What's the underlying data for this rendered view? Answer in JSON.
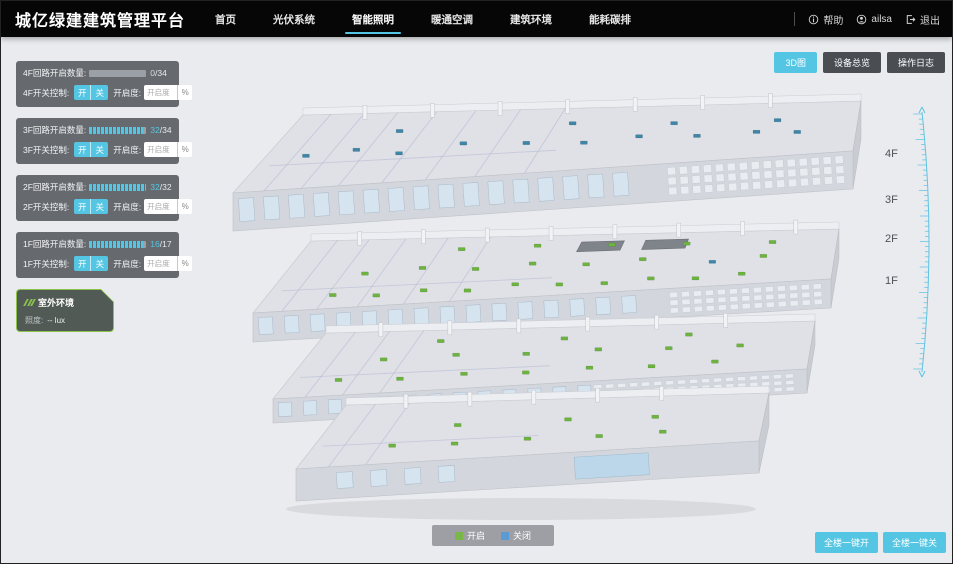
{
  "header": {
    "title": "城亿绿建建筑管理平台",
    "nav": [
      {
        "label": "首页",
        "active": false
      },
      {
        "label": "光伏系统",
        "active": false
      },
      {
        "label": "智能照明",
        "active": true
      },
      {
        "label": "暖通空调",
        "active": false
      },
      {
        "label": "建筑环境",
        "active": false
      },
      {
        "label": "能耗碳排",
        "active": false
      }
    ],
    "help_label": "帮助",
    "user_name": "ailsa",
    "logout_label": "退出"
  },
  "view_toolbar": {
    "buttons": [
      {
        "label": "3D图",
        "active": true
      },
      {
        "label": "设备总览",
        "active": false
      },
      {
        "label": "操作日志",
        "active": false
      }
    ]
  },
  "floor_panels": [
    {
      "floor": "4F",
      "circuit_label": "4F回路开启数量:",
      "current": "0",
      "total": "34",
      "progress": 0,
      "switch_label": "4F开关控制:",
      "on_label": "开",
      "off_label": "关",
      "dim_label": "开启度:",
      "dim_placeholder": "开启度",
      "unit_label": "%"
    },
    {
      "floor": "3F",
      "circuit_label": "3F回路开启数量:",
      "current": "32",
      "total": "34",
      "progress": 94,
      "switch_label": "3F开关控制:",
      "on_label": "开",
      "off_label": "关",
      "dim_label": "开启度:",
      "dim_placeholder": "开启度",
      "unit_label": "%"
    },
    {
      "floor": "2F",
      "circuit_label": "2F回路开启数量:",
      "current": "32",
      "total": "32",
      "progress": 100,
      "switch_label": "2F开关控制:",
      "on_label": "开",
      "off_label": "关",
      "dim_label": "开启度:",
      "dim_placeholder": "开启度",
      "unit_label": "%"
    },
    {
      "floor": "1F",
      "circuit_label": "1F回路开启数量:",
      "current": "16",
      "total": "17",
      "progress": 94,
      "switch_label": "1F开关控制:",
      "on_label": "开",
      "off_label": "关",
      "dim_label": "开启度:",
      "dim_placeholder": "开启度",
      "unit_label": "%"
    }
  ],
  "outdoor_panel": {
    "title": "室外环境",
    "metric_label": "照度:",
    "metric_value": "--",
    "metric_unit": "lux"
  },
  "floor_scale": {
    "labels": [
      "4F",
      "3F",
      "2F",
      "1F"
    ]
  },
  "legend": {
    "items": [
      {
        "label": "开启",
        "color": "#7ab648"
      },
      {
        "label": "关闭",
        "color": "#5b9bd5"
      }
    ]
  },
  "bottom_actions": {
    "buttons": [
      "全楼一键开",
      "全楼一键关"
    ]
  },
  "colors": {
    "accent": "#54c6e3",
    "marker_on": "#6cb33f",
    "marker_off": "#3f86a6"
  }
}
